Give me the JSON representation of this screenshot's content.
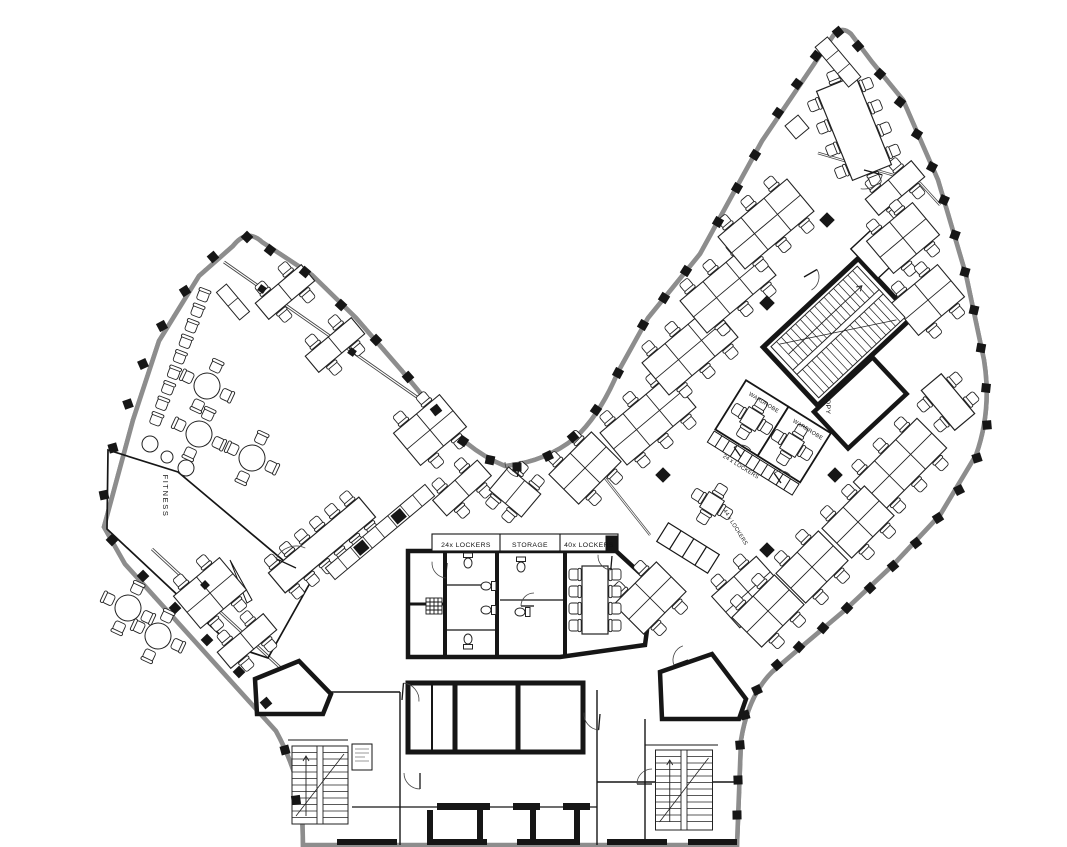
{
  "labels": {
    "fitness": "FITNESS",
    "core_lockers_24": "24x LOCKERS",
    "core_storage": "STORAGE",
    "core_lockers_40": "40x LOCKERS",
    "wardrobe_a": "WARDROBE",
    "wardrobe_b": "WARDROBE",
    "corridor_lockers_24": "24 x LOCKERS",
    "corridor_lockers_44": "44 x LOCKERS",
    "copy_room": "COPY"
  },
  "colors": {
    "wall": "#161616",
    "thin": "#2b2b2b",
    "facade_gray": "#8d8d8d",
    "background": "#ffffff"
  },
  "plan": {
    "facade_columns": [
      [
        247,
        237,
        45
      ],
      [
        213,
        257,
        50
      ],
      [
        185,
        291,
        58
      ],
      [
        162,
        326,
        62
      ],
      [
        143,
        364,
        66
      ],
      [
        128,
        404,
        70
      ],
      [
        113,
        448,
        74
      ],
      [
        104,
        495,
        78
      ],
      [
        112,
        540,
        46
      ],
      [
        143,
        576,
        46
      ],
      [
        175,
        608,
        46
      ],
      [
        207,
        640,
        46
      ],
      [
        239,
        672,
        46
      ],
      [
        266,
        703,
        50
      ],
      [
        285,
        750,
        75
      ],
      [
        296,
        800,
        82
      ],
      [
        270,
        250,
        38
      ],
      [
        305,
        272,
        40
      ],
      [
        341,
        305,
        43
      ],
      [
        376,
        340,
        46
      ],
      [
        408,
        377,
        48
      ],
      [
        436,
        410,
        52
      ],
      [
        463,
        441,
        35
      ],
      [
        490,
        460,
        12
      ],
      [
        517,
        467,
        0
      ],
      [
        548,
        456,
        -25
      ],
      [
        573,
        437,
        -40
      ],
      [
        596,
        410,
        -55
      ],
      [
        618,
        373,
        -62
      ],
      [
        643,
        325,
        -60
      ],
      [
        664,
        298,
        -58
      ],
      [
        686,
        271,
        -57
      ],
      [
        718,
        222,
        -60
      ],
      [
        737,
        188,
        -60
      ],
      [
        755,
        155,
        -58
      ],
      [
        778,
        113,
        -55
      ],
      [
        797,
        84,
        -53
      ],
      [
        816,
        56,
        -52
      ],
      [
        838,
        32,
        -40
      ],
      [
        858,
        46,
        -42
      ],
      [
        880,
        74,
        -47
      ],
      [
        900,
        102,
        -52
      ],
      [
        917,
        134,
        -58
      ],
      [
        932,
        167,
        -62
      ],
      [
        944,
        200,
        -66
      ],
      [
        955,
        235,
        -70
      ],
      [
        965,
        272,
        -74
      ],
      [
        974,
        310,
        -77
      ],
      [
        981,
        348,
        -80
      ],
      [
        986,
        388,
        -84
      ],
      [
        987,
        425,
        85
      ],
      [
        977,
        458,
        72
      ],
      [
        959,
        490,
        63
      ],
      [
        938,
        518,
        57
      ],
      [
        916,
        543,
        52
      ],
      [
        893,
        566,
        49
      ],
      [
        870,
        588,
        46
      ],
      [
        847,
        608,
        44
      ],
      [
        823,
        628,
        42
      ],
      [
        799,
        647,
        43
      ],
      [
        777,
        665,
        48
      ],
      [
        757,
        690,
        65
      ],
      [
        745,
        715,
        75
      ],
      [
        740,
        745,
        85
      ],
      [
        738,
        780,
        88
      ],
      [
        737,
        815,
        89
      ]
    ],
    "interior_columns": [
      [
        767,
        303
      ],
      [
        835,
        475
      ],
      [
        767,
        550
      ],
      [
        663,
        475
      ],
      [
        827,
        220
      ]
    ],
    "mullions": [
      [
        262,
        289,
        35
      ],
      [
        352,
        352,
        35
      ],
      [
        205,
        585,
        46
      ]
    ],
    "desk_clusters": [
      [
        285,
        292,
        -40,
        2,
        1
      ],
      [
        335,
        345,
        -40,
        2,
        1
      ],
      [
        430,
        430,
        -40,
        2,
        2
      ],
      [
        462,
        488,
        -42,
        2,
        1
      ],
      [
        515,
        492,
        -50,
        1,
        2
      ],
      [
        210,
        593,
        -40,
        2,
        2
      ],
      [
        247,
        641,
        -40,
        2,
        1
      ],
      [
        585,
        468,
        -45,
        2,
        2
      ],
      [
        650,
        598,
        -45,
        2,
        2
      ],
      [
        748,
        592,
        -42,
        2,
        2
      ],
      [
        648,
        420,
        -40,
        3,
        2
      ],
      [
        690,
        350,
        -40,
        3,
        2
      ],
      [
        728,
        288,
        -40,
        3,
        2
      ],
      [
        766,
        224,
        -40,
        3,
        2
      ],
      [
        895,
        188,
        -40,
        2,
        1
      ],
      [
        903,
        238,
        -40,
        2,
        2
      ],
      [
        928,
        300,
        -40,
        2,
        2
      ],
      [
        900,
        465,
        -45,
        3,
        2
      ],
      [
        858,
        522,
        -45,
        2,
        2
      ],
      [
        812,
        567,
        -45,
        2,
        2
      ],
      [
        768,
        611,
        -45,
        2,
        2
      ]
    ],
    "round_tables": [
      [
        207,
        386
      ],
      [
        199,
        434
      ],
      [
        252,
        458
      ],
      [
        128,
        608
      ],
      [
        158,
        636
      ]
    ],
    "lounge_circles": [
      [
        150,
        444,
        8
      ],
      [
        167,
        457,
        6
      ],
      [
        186,
        468,
        8
      ]
    ],
    "square_tables": [
      [
        712,
        504,
        32
      ],
      [
        752,
        419,
        32
      ],
      [
        792,
        445,
        32
      ]
    ],
    "long_tables": [
      {
        "x": 854,
        "y": 128,
        "rot": -22,
        "w": 42,
        "h": 96,
        "side": 4,
        "ends": true
      },
      {
        "x": 595,
        "y": 600,
        "rot": 0,
        "w": 26,
        "h": 68,
        "side": 4,
        "ends": false
      },
      {
        "x": 948,
        "y": 402,
        "rot": -40,
        "w": 26,
        "h": 52,
        "side": 2,
        "ends": false
      },
      {
        "x": 322,
        "y": 545,
        "rot": 50,
        "w": 26,
        "h": 118,
        "side": 6,
        "ends": false
      }
    ],
    "counters": [
      {
        "x": 380,
        "y": 532,
        "rot": 50,
        "w": 15,
        "h": 130,
        "cells": 8,
        "dark": [
          2,
          5
        ]
      },
      {
        "x": 233,
        "y": 302,
        "rot": -40,
        "w": 13,
        "h": 36,
        "cells": 2,
        "dark": []
      },
      {
        "x": 838,
        "y": 62,
        "rot": -40,
        "w": 16,
        "h": 52,
        "cells": 3,
        "dark": []
      },
      {
        "x": 797,
        "y": 127,
        "rot": -40,
        "w": 17,
        "h": 17,
        "cells": 1,
        "dark": []
      }
    ],
    "chair_rows": [
      {
        "x1": 203,
        "y1": 296,
        "x2": 156,
        "y2": 420,
        "n": 9
      }
    ],
    "stairs": [
      {
        "x": 320,
        "y": 785,
        "rot": 0,
        "w": 56,
        "h": 78
      },
      {
        "x": 684,
        "y": 790,
        "rot": 0,
        "w": 57,
        "h": 80
      },
      {
        "x": 838,
        "y": 332,
        "rot": 47,
        "w": 70,
        "h": 118
      }
    ],
    "toilets": [
      [
        468,
        562,
        0
      ],
      [
        487,
        586,
        90
      ],
      [
        487,
        610,
        90
      ],
      [
        468,
        640,
        180
      ],
      [
        521,
        566,
        0
      ],
      [
        521,
        612,
        90
      ]
    ],
    "doors": [
      [
        296,
        568,
        22,
        205,
        295
      ],
      [
        447,
        563,
        15,
        95,
        185
      ],
      [
        534,
        606,
        13,
        180,
        270
      ],
      [
        612,
        556,
        14,
        95,
        185
      ],
      [
        402,
        700,
        17,
        275,
        365
      ],
      [
        420,
        773,
        16,
        90,
        180
      ],
      [
        600,
        714,
        16,
        95,
        185
      ],
      [
        652,
        784,
        15,
        180,
        270
      ],
      [
        688,
        660,
        15,
        160,
        250
      ],
      [
        864,
        170,
        19,
        15,
        100
      ],
      [
        804,
        277,
        15,
        330,
        420
      ],
      [
        741,
        457,
        12,
        235,
        325
      ],
      [
        781,
        483,
        12,
        235,
        325
      ],
      [
        520,
        462,
        15,
        100,
        180
      ]
    ]
  }
}
